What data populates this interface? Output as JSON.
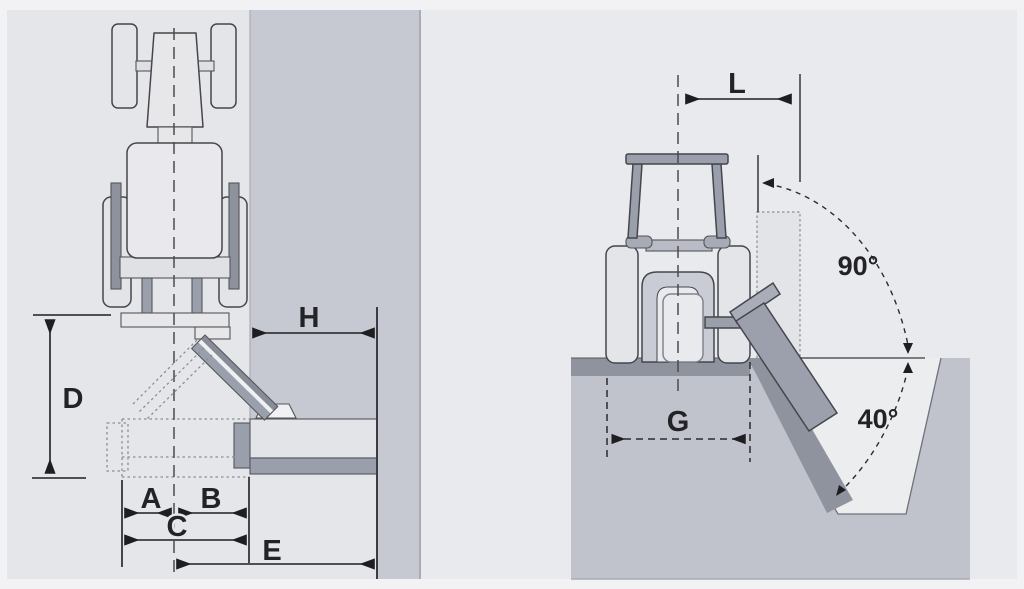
{
  "figure": {
    "description": "Tractor-mounted offset flail mower working-range dimension diagram, two views",
    "left_view": {
      "name": "top view, tractor with side-mounted mower head against bank",
      "dimension_labels": [
        "A",
        "B",
        "C",
        "D",
        "E",
        "H"
      ]
    },
    "right_view": {
      "name": "rear view, tractor mowing ditch bank with head rotation range",
      "dimension_labels": [
        "L",
        "G"
      ],
      "angle_labels": [
        "90°",
        "40°"
      ]
    }
  },
  "labels": {
    "A": "A",
    "B": "B",
    "C": "C",
    "D": "D",
    "E": "E",
    "H": "H",
    "L": "L",
    "G": "G",
    "angle_upper": "90°",
    "angle_lower": "40°"
  },
  "colors": {
    "page_margin": "#f2f2f4",
    "panel_left": "#e5e6e9",
    "panel_right": "#e9eaed",
    "bank_hedge": "#c6c8d2",
    "soil": "#c0c2cc",
    "ground_strip": "#8e939d",
    "machine_gray": "#9aa0ab",
    "machine_light": "#e4e5e9",
    "outline": "#45464c",
    "dimension_line": "#1e1e22"
  }
}
